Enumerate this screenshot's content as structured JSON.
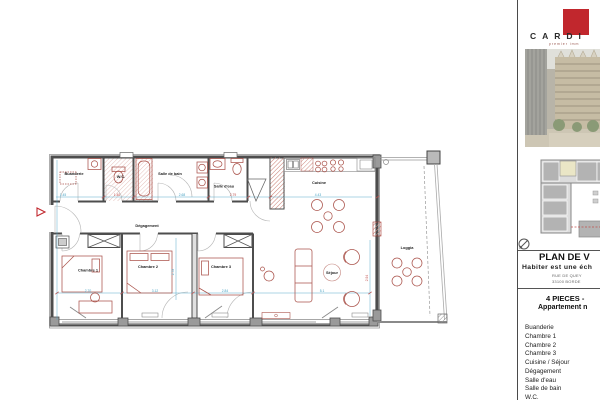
{
  "sidebar": {
    "brand": {
      "name": "CARDI",
      "tagline": "premier imm"
    },
    "title_block": {
      "title": "PLAN DE V",
      "subtitle": "Habiter est une éch",
      "address_line1": "RUE DE QUEY",
      "address_line2": "33100 BORDE"
    },
    "type_block": {
      "line1": "4 PIECES -",
      "line2": "Appartement n"
    },
    "room_list": [
      "Buanderie",
      "Chambre 1",
      "Chambre 2",
      "Chambre 3",
      "Cuisine / Séjour",
      "Dégagement",
      "Salle d'eau",
      "Salle de bain",
      "W.C."
    ],
    "icons": {
      "compass": "north-arrow-icon",
      "logo": "brand-logo-red-square"
    }
  },
  "plan": {
    "rooms": {
      "buanderie": "Buanderie",
      "wc": "W.C.",
      "salle_de_bain": "Salle de bain",
      "salle_deau": "Salle d'eau",
      "cuisine": "Cuisine",
      "degagement": "Dégagement",
      "chambre1": "Chambre 1",
      "chambre2": "Chambre 2",
      "chambre3": "Chambre 3",
      "sejour": "Séjour",
      "loggia": "Loggia"
    },
    "dims": {
      "buanderie_w": "1.45",
      "wc_w": "1.40",
      "sdb_w": "2.68",
      "sde_w": "2.79",
      "cuisine_w": "4.43",
      "ch1_w": "2.70",
      "ch2_w": "3.12",
      "ch3_w": "2.84",
      "sejour_w": "5.1",
      "ch2_h": "2.78",
      "right_h": "2.94"
    }
  },
  "colors": {
    "logo_red": "#c1272d",
    "furniture_red": "#ab544c",
    "dimension_teal": "#4aa3c4",
    "dim_text_red": "#c0504d",
    "wall_gray": "#4d4d4d",
    "hatch_pink": "#cf8d84"
  }
}
